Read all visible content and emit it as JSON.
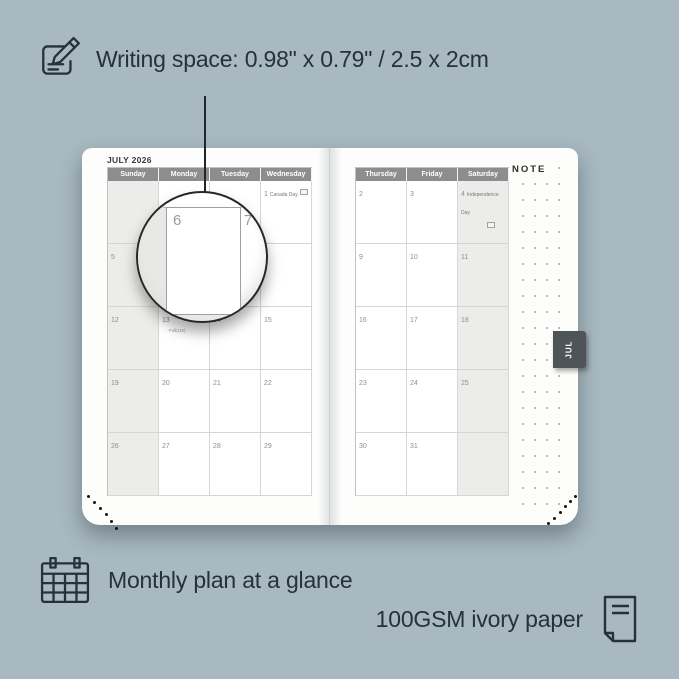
{
  "colors": {
    "background": "#a8b9c1",
    "annotation_text": "#24323a",
    "calendar_header": "#8d8d8d",
    "weekend_shade": "#ececea",
    "month_tab": "#4e5458",
    "page": "#fdfdfc"
  },
  "annotations": {
    "writing_space": "Writing space: 0.98\" x 0.79\" / 2.5 x 2cm",
    "monthly_plan": "Monthly plan at a glance",
    "paper": "100GSM ivory paper"
  },
  "planner": {
    "month_title": "JULY 2026",
    "left_page": {
      "day_headers": [
        "Sunday",
        "Monday",
        "Tuesday",
        "Wednesday"
      ],
      "shaded_column": "Sunday",
      "weeks": [
        [
          {
            "day": ""
          },
          {
            "day": ""
          },
          {
            "day": ""
          },
          {
            "day": "1",
            "holiday": "Canada Day",
            "flag": "inline"
          }
        ],
        [
          {
            "day": "5"
          },
          {
            "day": "6"
          },
          {
            "day": "7"
          },
          {
            "day": "8"
          }
        ],
        [
          {
            "day": "12"
          },
          {
            "day": "13",
            "note": "Full(US)"
          },
          {
            "day": "14"
          },
          {
            "day": "15"
          }
        ],
        [
          {
            "day": "19"
          },
          {
            "day": "20"
          },
          {
            "day": "21"
          },
          {
            "day": "22"
          }
        ],
        [
          {
            "day": "26"
          },
          {
            "day": "27"
          },
          {
            "day": "28"
          },
          {
            "day": "29"
          }
        ]
      ]
    },
    "right_page": {
      "day_headers": [
        "Thursday",
        "Friday",
        "Saturday"
      ],
      "shaded_column": "Saturday",
      "note_label": "NOTE",
      "month_tab": "JUL",
      "weeks": [
        [
          {
            "day": "2"
          },
          {
            "day": "3"
          },
          {
            "day": "4",
            "holiday": "Independence Day",
            "flag": "below"
          }
        ],
        [
          {
            "day": "9"
          },
          {
            "day": "10"
          },
          {
            "day": "11"
          }
        ],
        [
          {
            "day": "16"
          },
          {
            "day": "17"
          },
          {
            "day": "18"
          }
        ],
        [
          {
            "day": "23"
          },
          {
            "day": "24"
          },
          {
            "day": "25"
          }
        ],
        [
          {
            "day": "30"
          },
          {
            "day": "31"
          },
          {
            "day": ""
          }
        ]
      ]
    },
    "magnifier": {
      "day": "6",
      "adjacent_day": "7"
    }
  }
}
